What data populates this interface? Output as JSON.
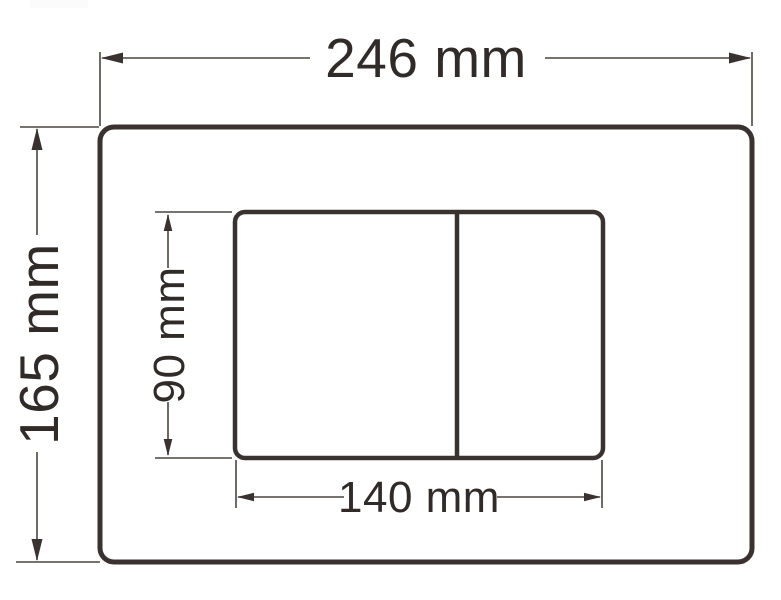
{
  "meta": {
    "background_color": "#ffffff",
    "line_color": "#3a3230",
    "thin_line_color": "#4c4540",
    "text_color": "#302a28"
  },
  "drawing": {
    "type": "technical-dimension-drawing",
    "subject": "dual-flush actuator plate, front view with dimensions",
    "labels": {
      "outer_width": "246 mm",
      "outer_height": "165 mm",
      "button_panel_width": "140 mm",
      "button_panel_height": "90 mm"
    },
    "values_mm": {
      "outer_width": 246,
      "outer_height": 165,
      "button_panel_width": 140,
      "button_panel_height": 90
    }
  }
}
